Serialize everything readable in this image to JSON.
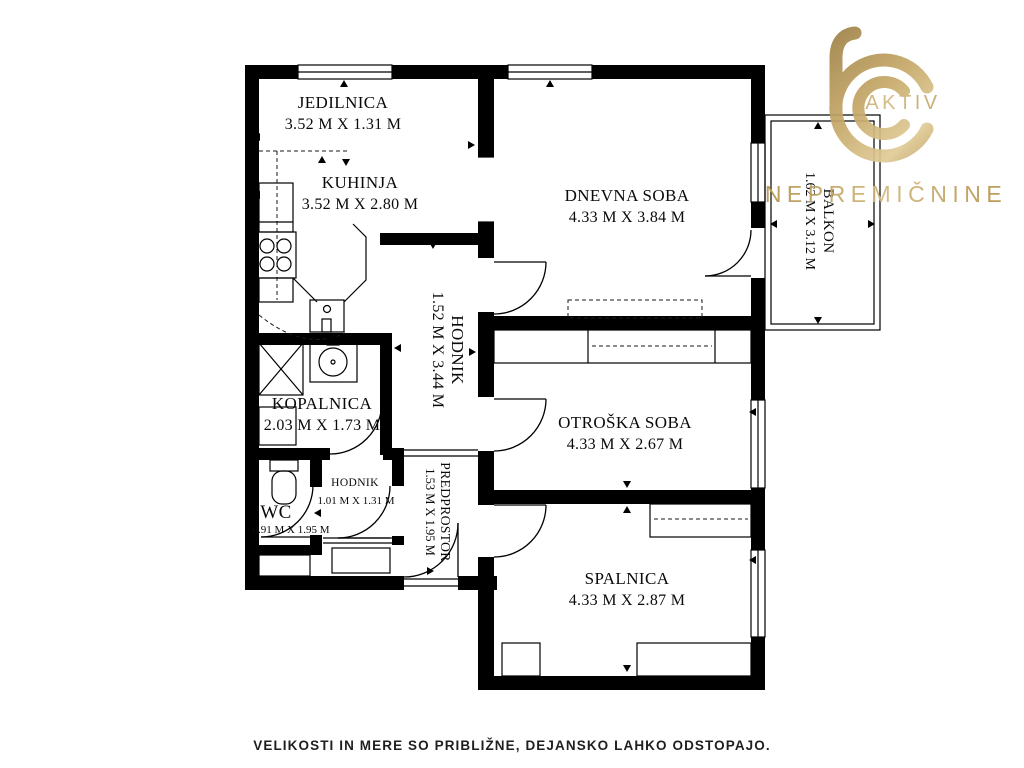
{
  "logo": {
    "brand_top": "AKTIV",
    "brand_bottom": "NEPREMIČNINE",
    "gold_dark": "#97793f",
    "gold_mid": "#c6a868",
    "gold_light": "#e6d4a3"
  },
  "disclaimer": "VELIKOSTI IN MERE SO PRIBLIŽNE, DEJANSKO LAHKO ODSTOPAJO.",
  "colors": {
    "walls": "#000000",
    "background": "#ffffff",
    "label_text": "#0a0a0a"
  },
  "rooms": [
    {
      "id": "jedilnica",
      "name": "JEDILNICA",
      "dimensions": "3.52 M X 1.31 M"
    },
    {
      "id": "kuhinja",
      "name": "KUHINJA",
      "dimensions": "3.52 M X 2.80 M"
    },
    {
      "id": "dnevna-soba",
      "name": "DNEVNA SOBA",
      "dimensions": "4.33 M X 3.84 M"
    },
    {
      "id": "balkon",
      "name": "BALKON",
      "dimensions": "1.62 M X 3.12 M"
    },
    {
      "id": "hodnik",
      "name": "HODNIK",
      "dimensions": "1.52 M X 3.44 M"
    },
    {
      "id": "kopalnica",
      "name": "KOPALNICA",
      "dimensions": "2.03 M X 1.73 M"
    },
    {
      "id": "otroska-soba",
      "name": "OTROŠKA SOBA",
      "dimensions": "4.33 M X 2.67 M"
    },
    {
      "id": "wc",
      "name": "WC",
      "dimensions": "0.91 M X 1.95 M"
    },
    {
      "id": "hodnik-mali",
      "name": "HODNIK",
      "dimensions": "1.01 M X 1.31 M"
    },
    {
      "id": "predprostor",
      "name": "PREDPROSTOR",
      "dimensions": "1.53 M X 1.95 M"
    },
    {
      "id": "spalnica",
      "name": "SPALNICA",
      "dimensions": "4.33 M X 2.87 M"
    }
  ]
}
